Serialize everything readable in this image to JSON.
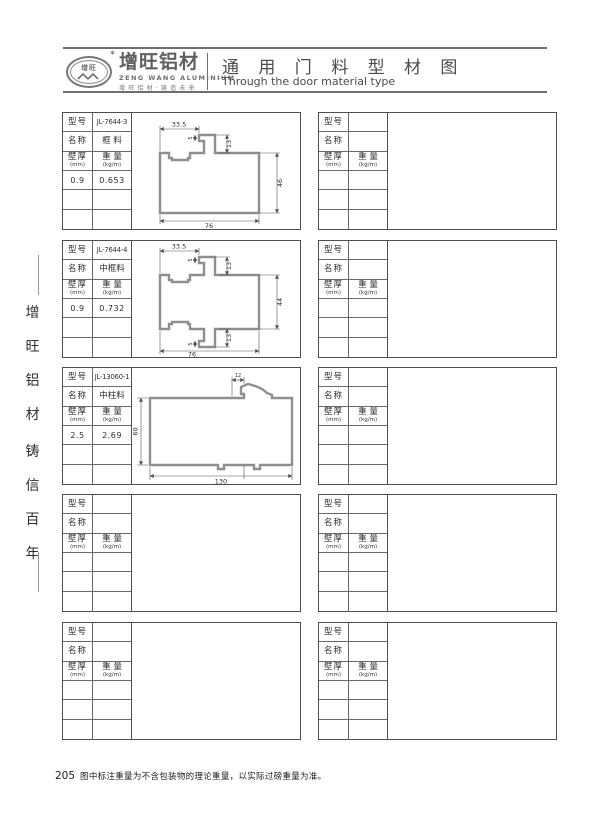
{
  "header": {
    "logo": {
      "mark": "增旺",
      "star": "*",
      "brand": "增旺铝材",
      "brand_en": "ZENG WANG ALUMINIUM",
      "slogan": "增旺铝材·铸造未来"
    },
    "title": "通 用 门 料 型 材 图",
    "subtitle": "Through the door material type"
  },
  "sidebar": {
    "chars": [
      "增",
      "旺",
      "铝",
      "材",
      "铸",
      "信",
      "百",
      "年"
    ]
  },
  "labels": {
    "model": "型号",
    "name": "名称",
    "thickness": "壁厚",
    "thickness_unit": "(mm)",
    "weight": "重 量",
    "weight_unit": "(kg/m)"
  },
  "profiles": [
    {
      "model": "JL-7644-3",
      "name": "框 料",
      "thickness": "0.9",
      "weight": "0.653",
      "dims": {
        "top_width": "33.5",
        "hook": "5",
        "tab_height": "13",
        "height": "46",
        "width": "76"
      }
    },
    {
      "model": "JL-7644-4",
      "name": "中框料",
      "thickness": "0.9",
      "weight": "0.732",
      "dims": {
        "top_width": "33.5",
        "hook_top": "5",
        "tab_top": "13",
        "height": "44",
        "hook_bottom": "5",
        "tab_bottom": "13",
        "width": "76"
      }
    },
    {
      "model": "JL-13060-1",
      "name": "中柱料",
      "thickness": "2.5",
      "weight": "2.69",
      "dims": {
        "top": "12",
        "height": "60",
        "width": "130"
      }
    }
  ],
  "footer": {
    "page": "205",
    "note": "图中标注重量为不含包装物的理论重量，以实际过磅重量为准。"
  }
}
